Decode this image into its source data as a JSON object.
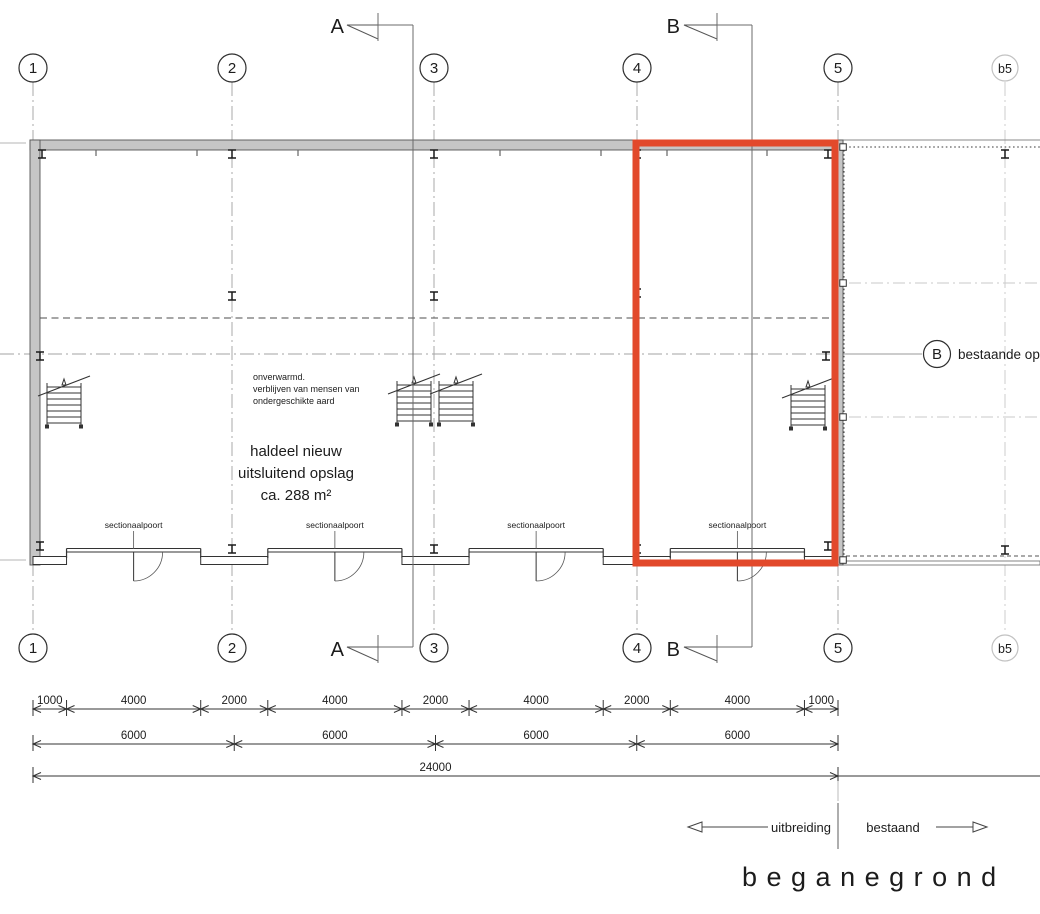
{
  "colors": {
    "highlight": "#e2492b",
    "wall_fill": "#c6c6c6",
    "ink": "#1c1c1c"
  },
  "sections": {
    "a": "A",
    "b": "B"
  },
  "grid": {
    "columns": [
      {
        "label": "1",
        "existing": false
      },
      {
        "label": "2",
        "existing": false
      },
      {
        "label": "3",
        "existing": false
      },
      {
        "label": "4",
        "existing": false
      },
      {
        "label": "5",
        "existing": false
      },
      {
        "label": "b5",
        "existing": true
      }
    ]
  },
  "room": {
    "note_lines": [
      "onverwarmd.",
      "verblijven van mensen van",
      "ondergeschikte aard"
    ],
    "name_lines": [
      "haldeel  nieuw",
      "uitsluitend opslag",
      "ca. 288 m²"
    ]
  },
  "doors": {
    "label": "sectionaalpoort"
  },
  "existing": {
    "bubble_label": "B",
    "annotation": "bestaande ops"
  },
  "dimensions": {
    "row1_mm": [
      1000,
      4000,
      2000,
      4000,
      2000,
      4000,
      2000,
      4000,
      1000
    ],
    "row2_mm": [
      6000,
      6000,
      6000,
      6000
    ],
    "row3_mm": [
      24000
    ]
  },
  "legend": {
    "left_label": "uitbreiding",
    "right_label": "bestaand"
  },
  "title": "beganegrond"
}
